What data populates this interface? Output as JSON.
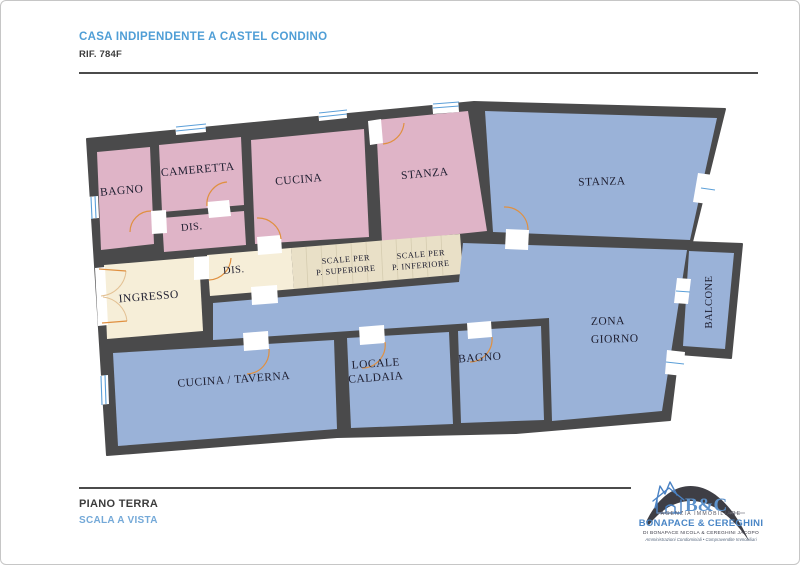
{
  "header": {
    "title": "CASA INDIPENDENTE A CASTEL CONDINO",
    "reference": "RIF. 784F",
    "title_color": "#4f9ed6",
    "text_color": "#3c3c3c"
  },
  "floorplan": {
    "colors": {
      "wall": "#4a4a4b",
      "room_pink": "#dfb4c7",
      "room_blue": "#9ab2d8",
      "room_cream": "#f6eed8",
      "room_tan": "#e9e0c7",
      "door_arc": "#e09040",
      "window_glass": "#5b9fd8",
      "label_text": "#1e1e30"
    },
    "labels": {
      "bagno1": "BAGNO",
      "cameretta": "CAMERETTA",
      "dis1": "DIS.",
      "cucina": "CUCINA",
      "stanza1": "STANZA",
      "stanza2": "STANZA",
      "ingresso": "INGRESSO",
      "dis2": "DIS.",
      "scale_sup_line1": "SCALE PER",
      "scale_sup_line2": "P. SUPERIORE",
      "scale_inf_line1": "SCALE PER",
      "scale_inf_line2": "P. INFERIORE",
      "cucina_taverna": "CUCINA / TAVERNA",
      "locale_caldaia_line1": "LOCALE",
      "locale_caldaia_line2": "CALDAIA",
      "bagno2": "BAGNO",
      "zona_giorno_line1": "ZONA",
      "zona_giorno_line2": "GIORNO",
      "balcone": "BALCONE"
    }
  },
  "footer": {
    "floor": "PIANO TERRA",
    "note": "SCALA A VISTA",
    "note_color": "#74a9d8"
  },
  "logo": {
    "brand": "B&C",
    "tagline": "AGENZIA IMMOBILIARE",
    "company": "BONAPACE & CEREGHINI",
    "subline": "DI BONAPACE NICOLA & CEREGHINI JACOPO",
    "services": "Amministrazioni Condominiali • Compravendite Immobiliari",
    "brand_blue": "#4a86c6",
    "house_icon": "house-mountains-icon",
    "swoosh_color": "#3e3e45"
  }
}
